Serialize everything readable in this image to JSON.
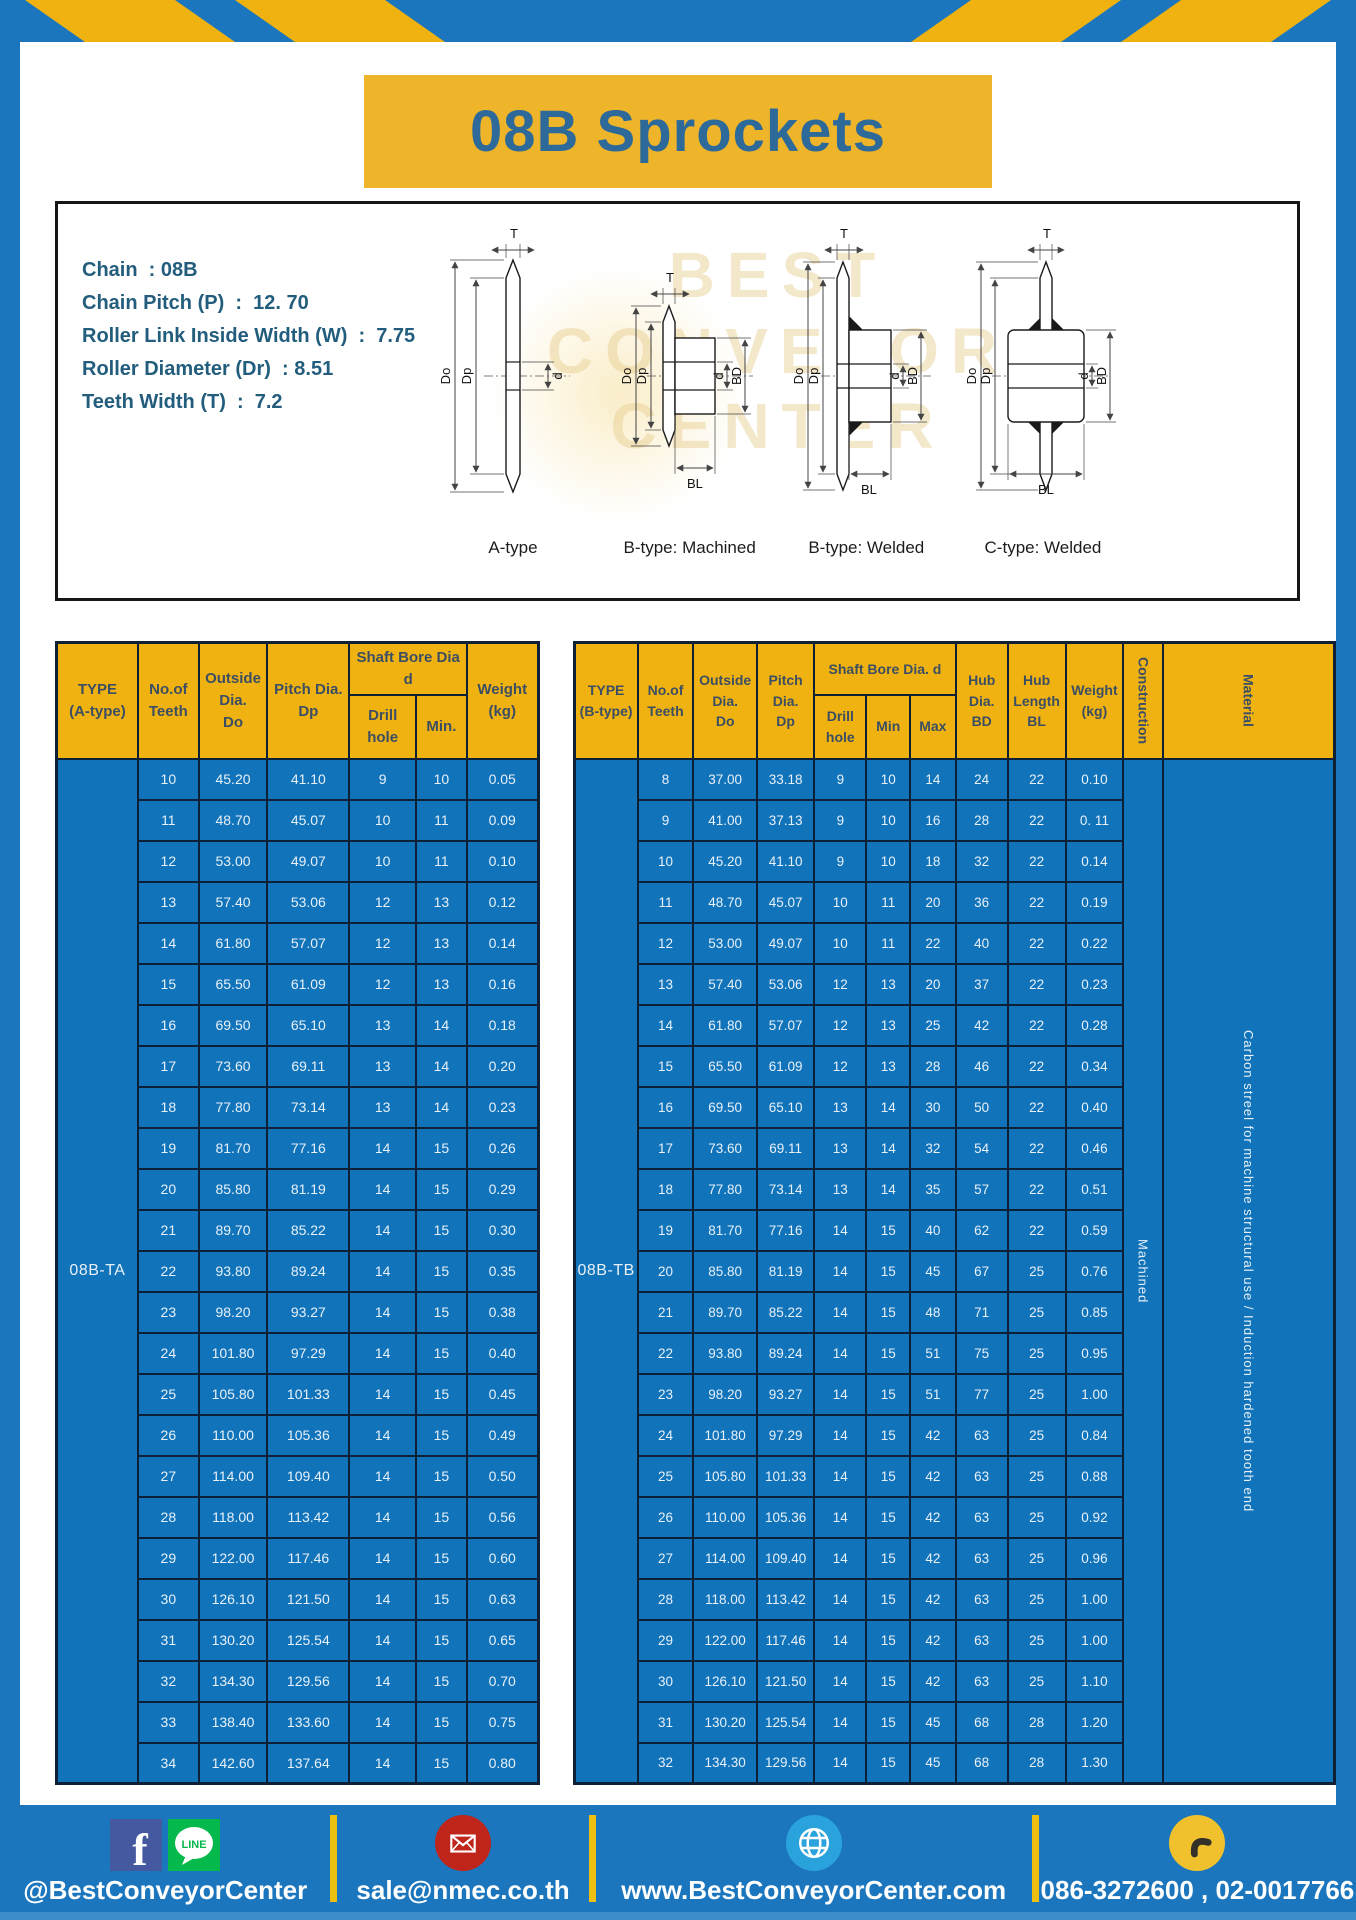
{
  "colors": {
    "frame_blue": "#1b76bd",
    "stripe_yellow": "#efb211",
    "title_box_yellow": "#eeb42a",
    "title_text_blue": "#2e6a99",
    "table_header_yellow": "#efb211",
    "table_cell_blue": "#1173ba",
    "table_border_navy": "#0e2036"
  },
  "header": {
    "title": "08B Sprockets"
  },
  "specs": [
    "Chain  : 08B",
    "Chain Pitch (P)  :  12. 70",
    "Roller Link Inside Width (W)  :  7.75",
    "Roller Diameter (Dr)  : 8.51",
    "Teeth Width (T)  :  7.2"
  ],
  "watermark": {
    "line1": "BEST",
    "line2": "CONVEYOR",
    "line3": "CENTER"
  },
  "diagrams": {
    "dims": {
      "T": "T",
      "Do": "Do",
      "Dp": "Dp",
      "d": "d",
      "BD": "BD",
      "BL": "BL"
    },
    "types": [
      "A-type",
      "B-type: Machined",
      "B-type: Welded",
      "C-type: Welded"
    ]
  },
  "left_table": {
    "headers": {
      "type": "TYPE\n(A-type)",
      "teeth": "No.of\nTeeth",
      "outside": "Outside\nDia.\nDo",
      "pitch": "Pitch Dia.\nDp",
      "bore": "Shaft Bore Dia d",
      "drill": "Drill hole",
      "min": "Min.",
      "weight": "Weight\n(kg)"
    },
    "type_label": "08B-TA",
    "rows": [
      [
        "10",
        "45.20",
        "41.10",
        "9",
        "10",
        "0.05"
      ],
      [
        "11",
        "48.70",
        "45.07",
        "10",
        "11",
        "0.09"
      ],
      [
        "12",
        "53.00",
        "49.07",
        "10",
        "11",
        "0.10"
      ],
      [
        "13",
        "57.40",
        "53.06",
        "12",
        "13",
        "0.12"
      ],
      [
        "14",
        "61.80",
        "57.07",
        "12",
        "13",
        "0.14"
      ],
      [
        "15",
        "65.50",
        "61.09",
        "12",
        "13",
        "0.16"
      ],
      [
        "16",
        "69.50",
        "65.10",
        "13",
        "14",
        "0.18"
      ],
      [
        "17",
        "73.60",
        "69.11",
        "13",
        "14",
        "0.20"
      ],
      [
        "18",
        "77.80",
        "73.14",
        "13",
        "14",
        "0.23"
      ],
      [
        "19",
        "81.70",
        "77.16",
        "14",
        "15",
        "0.26"
      ],
      [
        "20",
        "85.80",
        "81.19",
        "14",
        "15",
        "0.29"
      ],
      [
        "21",
        "89.70",
        "85.22",
        "14",
        "15",
        "0.30"
      ],
      [
        "22",
        "93.80",
        "89.24",
        "14",
        "15",
        "0.35"
      ],
      [
        "23",
        "98.20",
        "93.27",
        "14",
        "15",
        "0.38"
      ],
      [
        "24",
        "101.80",
        "97.29",
        "14",
        "15",
        "0.40"
      ],
      [
        "25",
        "105.80",
        "101.33",
        "14",
        "15",
        "0.45"
      ],
      [
        "26",
        "110.00",
        "105.36",
        "14",
        "15",
        "0.49"
      ],
      [
        "27",
        "114.00",
        "109.40",
        "14",
        "15",
        "0.50"
      ],
      [
        "28",
        "118.00",
        "113.42",
        "14",
        "15",
        "0.56"
      ],
      [
        "29",
        "122.00",
        "117.46",
        "14",
        "15",
        "0.60"
      ],
      [
        "30",
        "126.10",
        "121.50",
        "14",
        "15",
        "0.63"
      ],
      [
        "31",
        "130.20",
        "125.54",
        "14",
        "15",
        "0.65"
      ],
      [
        "32",
        "134.30",
        "129.56",
        "14",
        "15",
        "0.70"
      ],
      [
        "33",
        "138.40",
        "133.60",
        "14",
        "15",
        "0.75"
      ],
      [
        "34",
        "142.60",
        "137.64",
        "14",
        "15",
        "0.80"
      ]
    ]
  },
  "right_table": {
    "headers": {
      "type": "TYPE\n(B-type)",
      "teeth": "No.of\nTeeth",
      "outside": "Outside\nDia.\nDo",
      "pitch": "Pitch\nDia.\nDp",
      "bore": "Shaft Bore Dia.  d",
      "drill": "Drill hole",
      "min": "Min",
      "max": "Max",
      "hub_dia": "Hub\nDia.\nBD",
      "hub_len": "Hub\nLength\nBL",
      "weight": "Weight\n(kg)",
      "construction": "Construction",
      "material": "Material"
    },
    "type_label": "08B-TB",
    "trailing": [
      {
        "name": "construction-cell",
        "text": "Machined"
      },
      {
        "name": "material-cell",
        "text": "Carbon streel for machine structural use / Induction hardened tooth end"
      }
    ],
    "rows": [
      [
        "8",
        "37.00",
        "33.18",
        "9",
        "10",
        "14",
        "24",
        "22",
        "0.10"
      ],
      [
        "9",
        "41.00",
        "37.13",
        "9",
        "10",
        "16",
        "28",
        "22",
        "0. 11"
      ],
      [
        "10",
        "45.20",
        "41.10",
        "9",
        "10",
        "18",
        "32",
        "22",
        "0.14"
      ],
      [
        "11",
        "48.70",
        "45.07",
        "10",
        "11",
        "20",
        "36",
        "22",
        "0.19"
      ],
      [
        "12",
        "53.00",
        "49.07",
        "10",
        "11",
        "22",
        "40",
        "22",
        "0.22"
      ],
      [
        "13",
        "57.40",
        "53.06",
        "12",
        "13",
        "20",
        "37",
        "22",
        "0.23"
      ],
      [
        "14",
        "61.80",
        "57.07",
        "12",
        "13",
        "25",
        "42",
        "22",
        "0.28"
      ],
      [
        "15",
        "65.50",
        "61.09",
        "12",
        "13",
        "28",
        "46",
        "22",
        "0.34"
      ],
      [
        "16",
        "69.50",
        "65.10",
        "13",
        "14",
        "30",
        "50",
        "22",
        "0.40"
      ],
      [
        "17",
        "73.60",
        "69.11",
        "13",
        "14",
        "32",
        "54",
        "22",
        "0.46"
      ],
      [
        "18",
        "77.80",
        "73.14",
        "13",
        "14",
        "35",
        "57",
        "22",
        "0.51"
      ],
      [
        "19",
        "81.70",
        "77.16",
        "14",
        "15",
        "40",
        "62",
        "22",
        "0.59"
      ],
      [
        "20",
        "85.80",
        "81.19",
        "14",
        "15",
        "45",
        "67",
        "25",
        "0.76"
      ],
      [
        "21",
        "89.70",
        "85.22",
        "14",
        "15",
        "48",
        "71",
        "25",
        "0.85"
      ],
      [
        "22",
        "93.80",
        "89.24",
        "14",
        "15",
        "51",
        "75",
        "25",
        "0.95"
      ],
      [
        "23",
        "98.20",
        "93.27",
        "14",
        "15",
        "51",
        "77",
        "25",
        "1.00"
      ],
      [
        "24",
        "101.80",
        "97.29",
        "14",
        "15",
        "42",
        "63",
        "25",
        "0.84"
      ],
      [
        "25",
        "105.80",
        "101.33",
        "14",
        "15",
        "42",
        "63",
        "25",
        "0.88"
      ],
      [
        "26",
        "110.00",
        "105.36",
        "14",
        "15",
        "42",
        "63",
        "25",
        "0.92"
      ],
      [
        "27",
        "114.00",
        "109.40",
        "14",
        "15",
        "42",
        "63",
        "25",
        "0.96"
      ],
      [
        "28",
        "118.00",
        "113.42",
        "14",
        "15",
        "42",
        "63",
        "25",
        "1.00"
      ],
      [
        "29",
        "122.00",
        "117.46",
        "14",
        "15",
        "42",
        "63",
        "25",
        "1.00"
      ],
      [
        "30",
        "126.10",
        "121.50",
        "14",
        "15",
        "42",
        "63",
        "25",
        "1.10"
      ],
      [
        "31",
        "130.20",
        "125.54",
        "14",
        "15",
        "45",
        "68",
        "28",
        "1.20"
      ],
      [
        "32",
        "134.30",
        "129.56",
        "14",
        "15",
        "45",
        "68",
        "28",
        "1.30"
      ]
    ]
  },
  "footer": {
    "social": "@BestConveyorCenter",
    "email": "sale@nmec.co.th",
    "website": "www.BestConveyorCenter.com",
    "phone": "086-3272600 , 02-0017766",
    "icons": {
      "facebook_letter": "f",
      "line_label": "LINE"
    }
  }
}
